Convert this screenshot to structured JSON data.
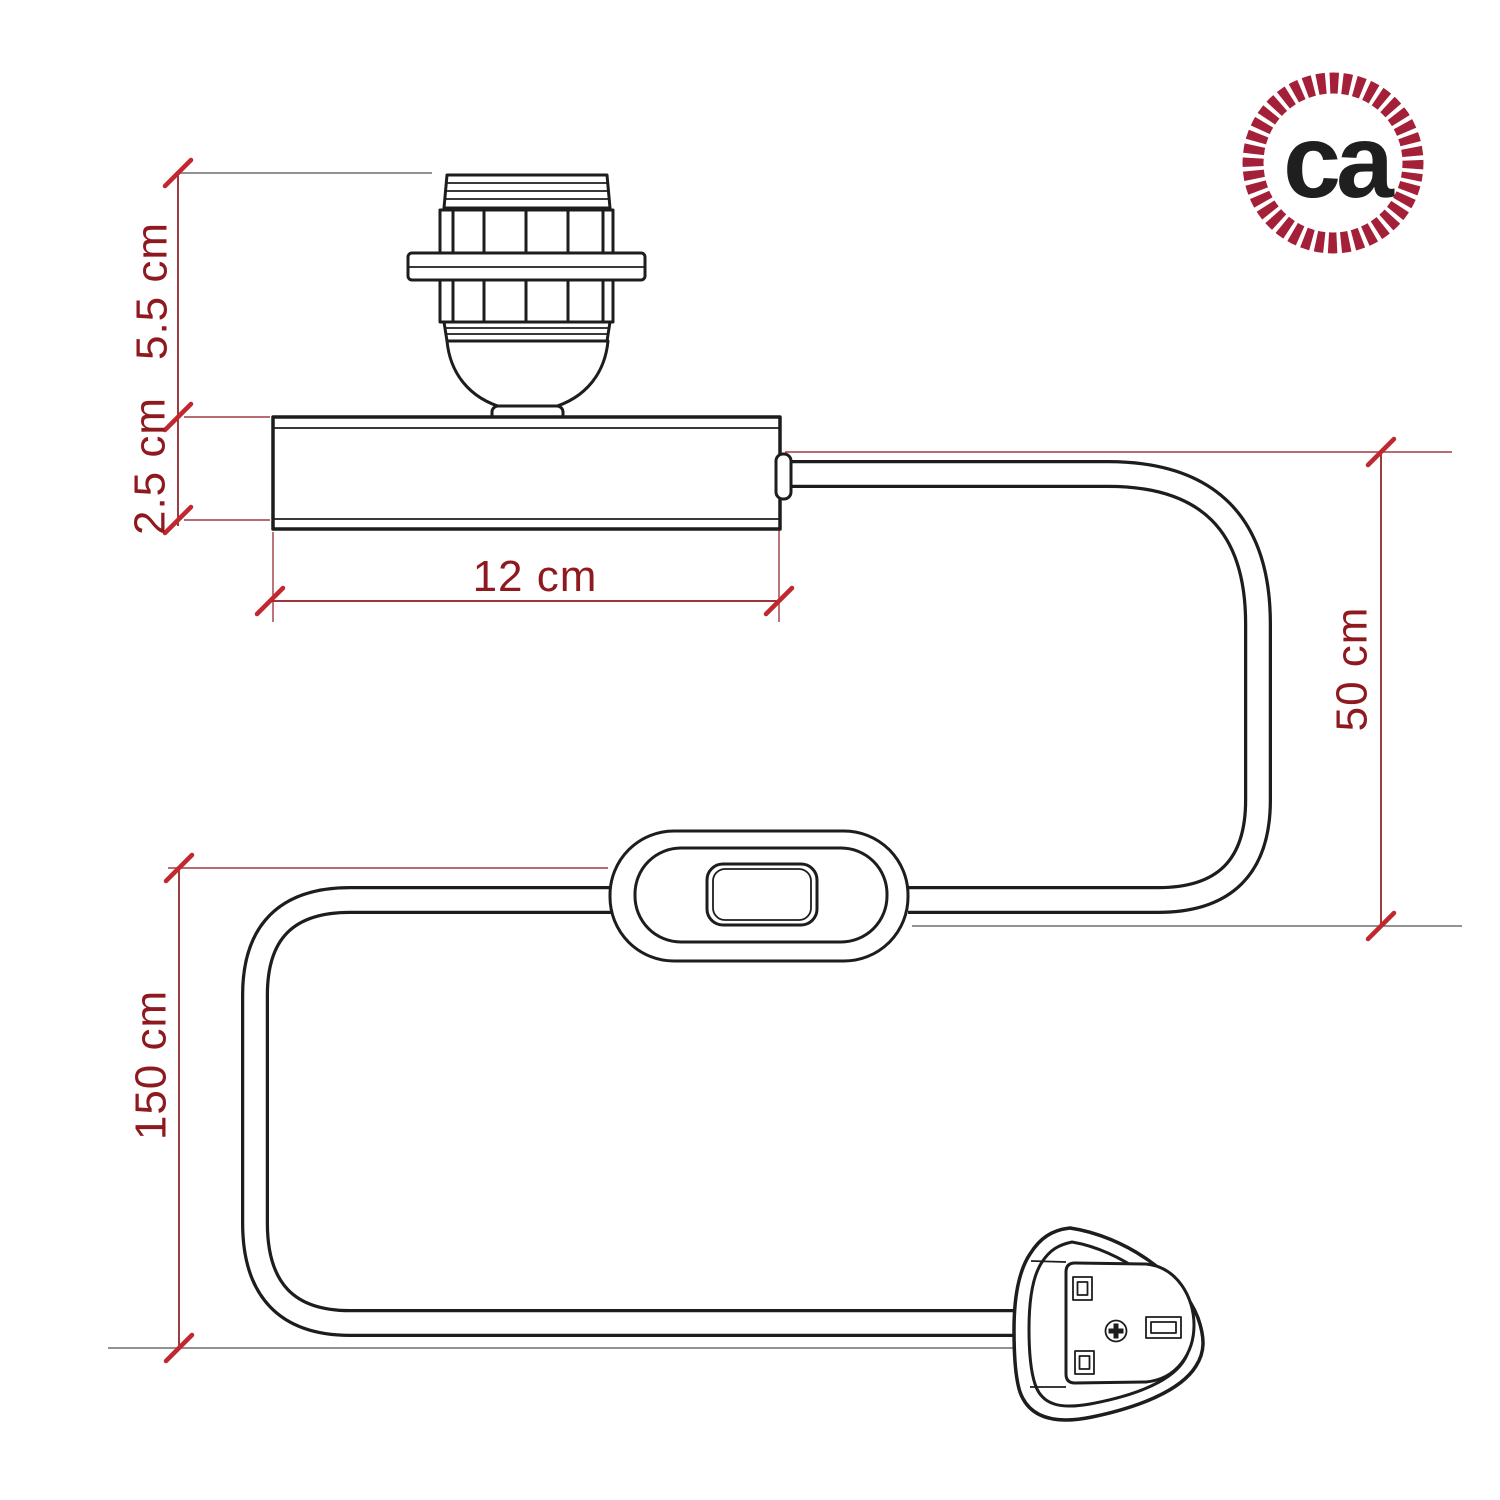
{
  "diagram": {
    "dimension_labels": {
      "lamp_holder_height": "5.5 cm",
      "base_height": "2.5 cm",
      "base_length": "12 cm",
      "cable_holder_to_switch": "50 cm",
      "cable_switch_to_plug": "150 cm"
    },
    "logo": {
      "monogram": "ca"
    },
    "colors": {
      "dimension_red": "#8e1a1f",
      "tick_red": "#c1272d",
      "extension_gray": "#6e6e6e",
      "line_black": "#1d1d1d",
      "logo_crimson": "#a32038",
      "background": "#ffffff"
    }
  }
}
